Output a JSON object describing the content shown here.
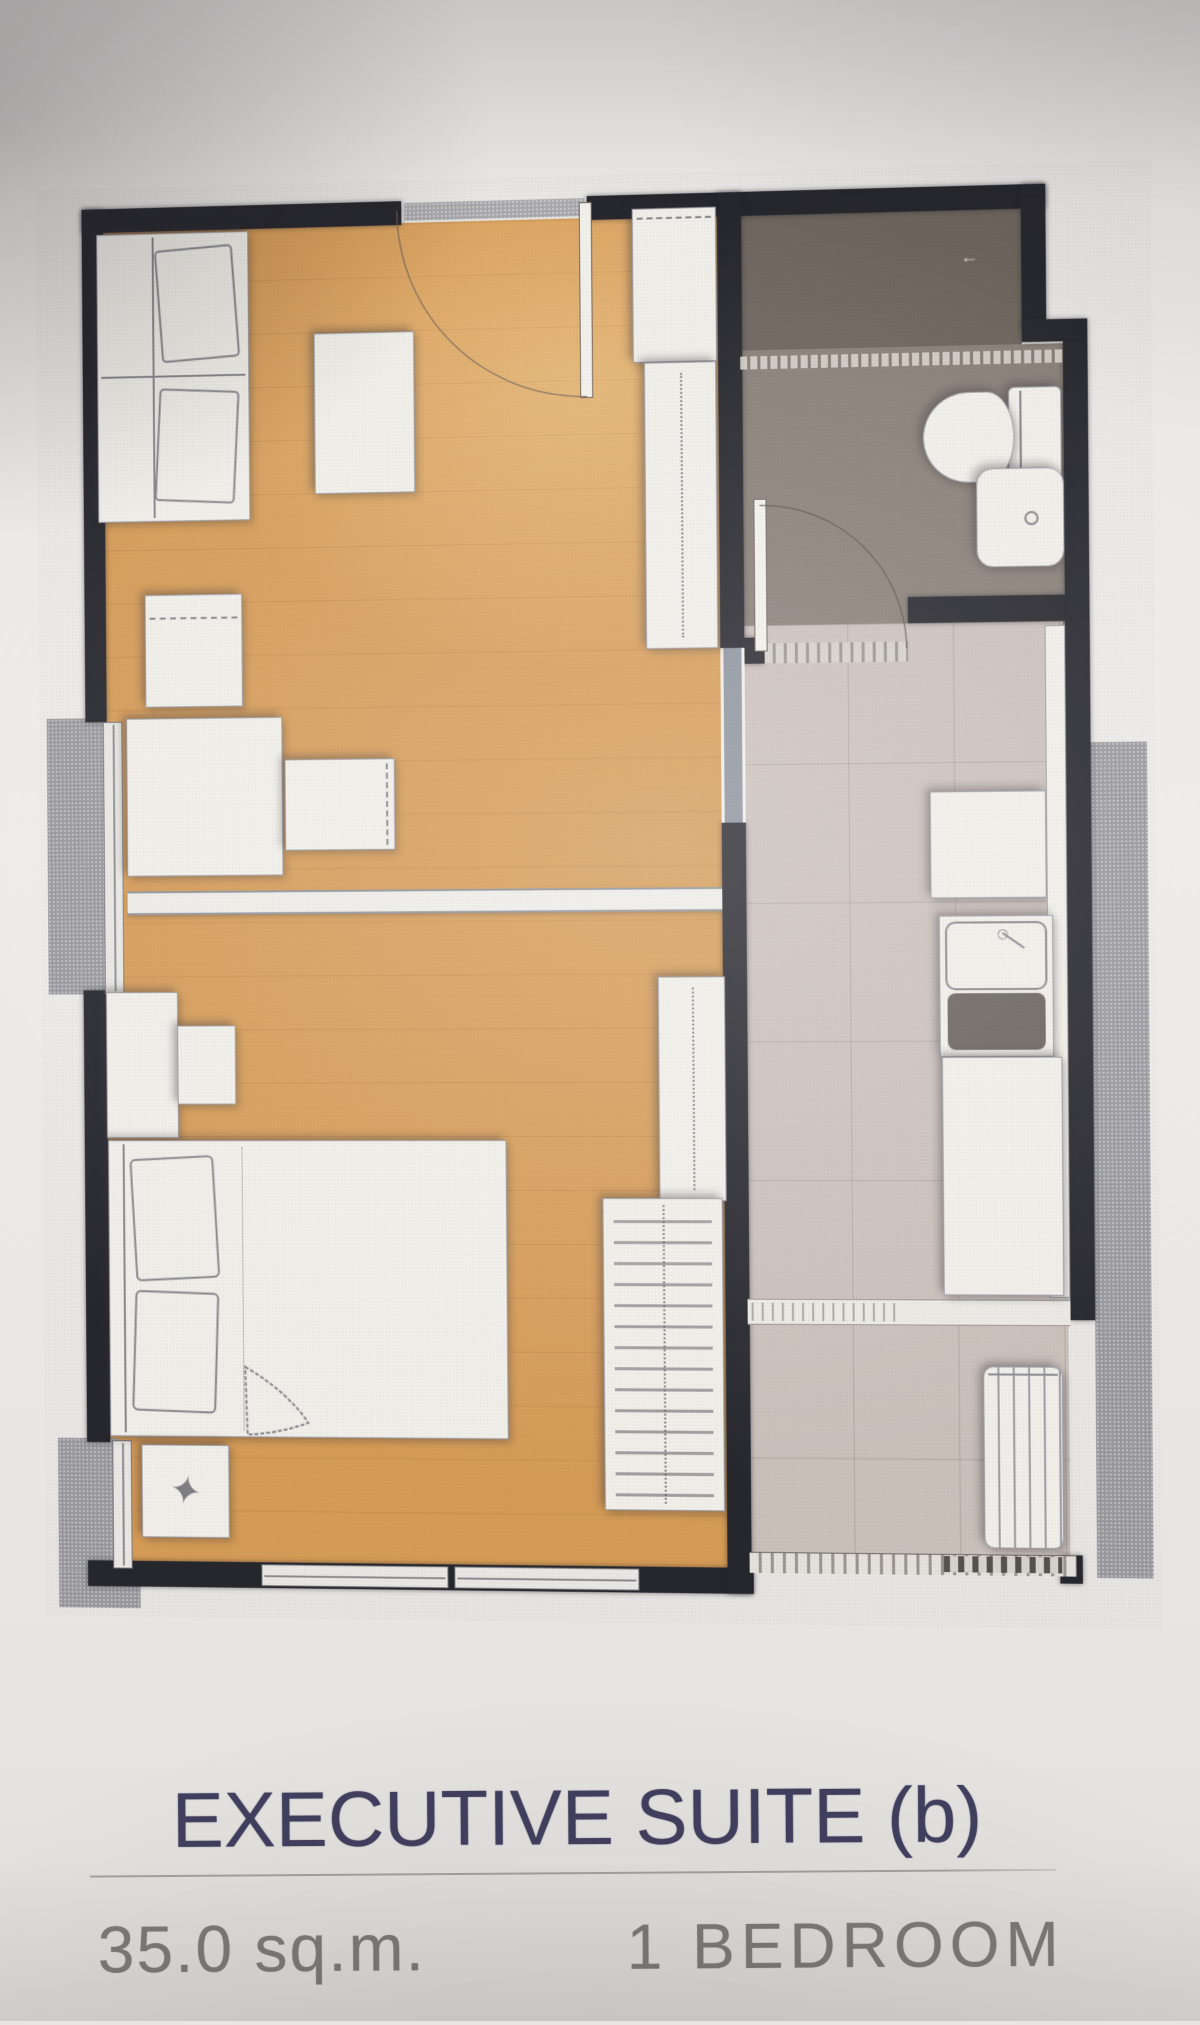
{
  "caption": {
    "title": "EXECUTIVE SUITE (b)",
    "area": "35.0 sq.m.",
    "bedrooms": "1 BEDROOM"
  },
  "plan": {
    "type": "condominium-unit-floor-plan",
    "unit_name": "Executive Suite (b)",
    "area_sqm": 35.0,
    "bedroom_count": 1,
    "rooms_depicted": [
      "living-area",
      "bedroom",
      "bathroom",
      "kitchen",
      "balcony-ledges"
    ],
    "fixtures_depicted": [
      "entrance-door",
      "sofa",
      "coffee-table",
      "shoe-cabinet",
      "tv-console",
      "desk",
      "stool",
      "room-divider",
      "double-bed",
      "nightstands",
      "wardrobe-with-hangers",
      "shelf-unit",
      "shower",
      "toilet",
      "wash-basin",
      "kitchen-counter",
      "kitchen-sink",
      "hob",
      "washing-machine",
      "windows",
      "railing"
    ]
  },
  "icons": {
    "decor_glyph": "✦",
    "shower_glyph": "←"
  },
  "colors": {
    "paper": "#e8e6e3",
    "wall": "#26262d",
    "wood": "#d69c57",
    "bath": "#8a8078",
    "bath_dark": "#6f665e",
    "tile": "#cbc1bb",
    "tile_line": "#b3a9a3",
    "balcony": "#97979c",
    "white": "#f1efe9",
    "sketch": "#85858b",
    "navy": "#413f5e",
    "gray_text": "#7d7c79",
    "rule": "#a3a2a0"
  }
}
